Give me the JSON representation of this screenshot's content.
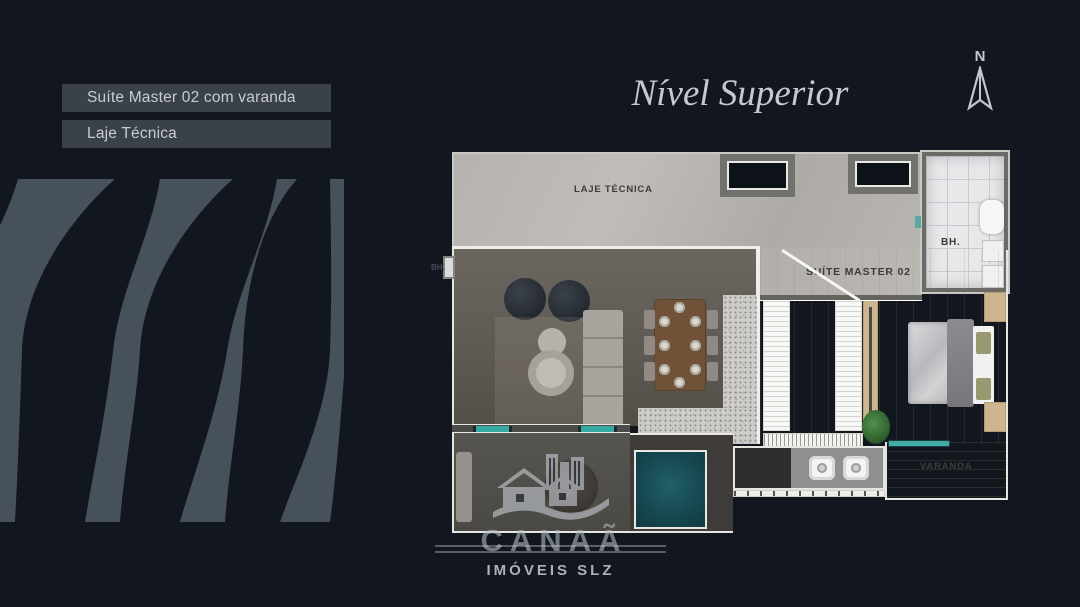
{
  "page": {
    "background": "#11161f"
  },
  "tags": {
    "tag1": "Suíte Master 02 com varanda",
    "tag2": "Laje Técnica"
  },
  "header": {
    "title": "Nível Superior"
  },
  "compass": {
    "north_label": "N"
  },
  "floorplan": {
    "labels": {
      "laje_tecnica": "LAJE TÉCNICA",
      "suite_master": "SUÍTE MASTER 02",
      "bathroom_right": "BH.",
      "bathroom_left": "BH.",
      "varanda_right": "VARANDA"
    },
    "accent_colors": {
      "window_teal": "#35aaa2",
      "pool_teal": "#1d565c",
      "chip_background": "#3a4149"
    }
  },
  "watermark": {
    "brand": "CANAÃ",
    "subtitle": "IMÓVEIS SLZ"
  }
}
